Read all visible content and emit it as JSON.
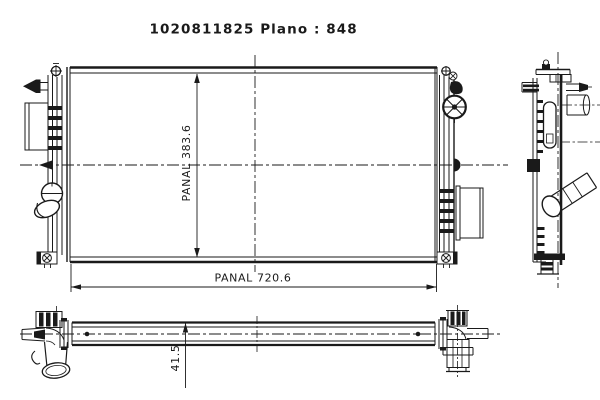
{
  "title": {
    "part_number": "1020811825",
    "plano": "Plano : 848"
  },
  "dimensions": {
    "core_height": {
      "text": "PANAL 383.6"
    },
    "core_width": {
      "text": "PANAL 720.6"
    },
    "tank_depth": {
      "text": "41.5"
    }
  },
  "colors": {
    "line": "#1a1a1a",
    "background": "#ffffff"
  }
}
